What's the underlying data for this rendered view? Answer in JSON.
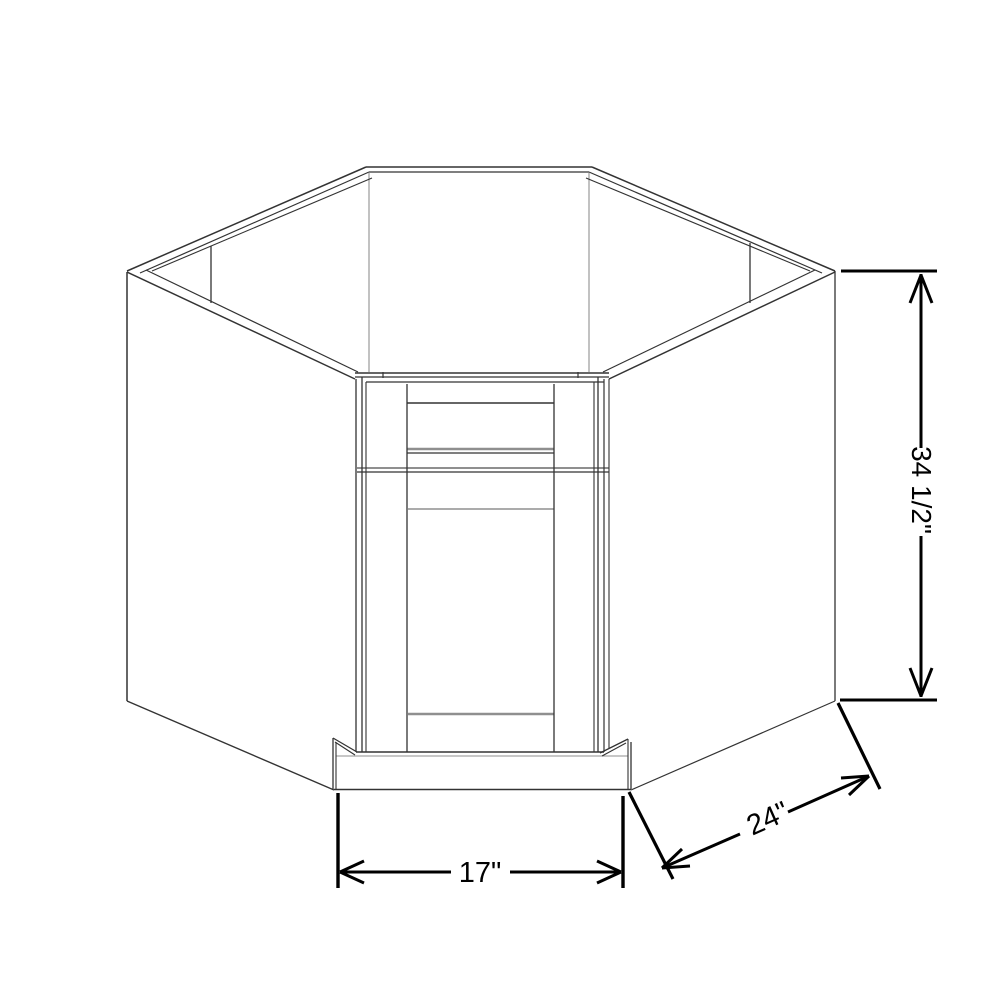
{
  "diagram": {
    "type": "cabinet-dimension-line-drawing",
    "labels": {
      "front_width": "17\"",
      "side_depth": "24\"",
      "height": "34 1/2\""
    },
    "colors": {
      "background": "#ffffff",
      "outline": "#333333",
      "panel_line": "#8f8f8f",
      "dimension": "#000000"
    }
  }
}
